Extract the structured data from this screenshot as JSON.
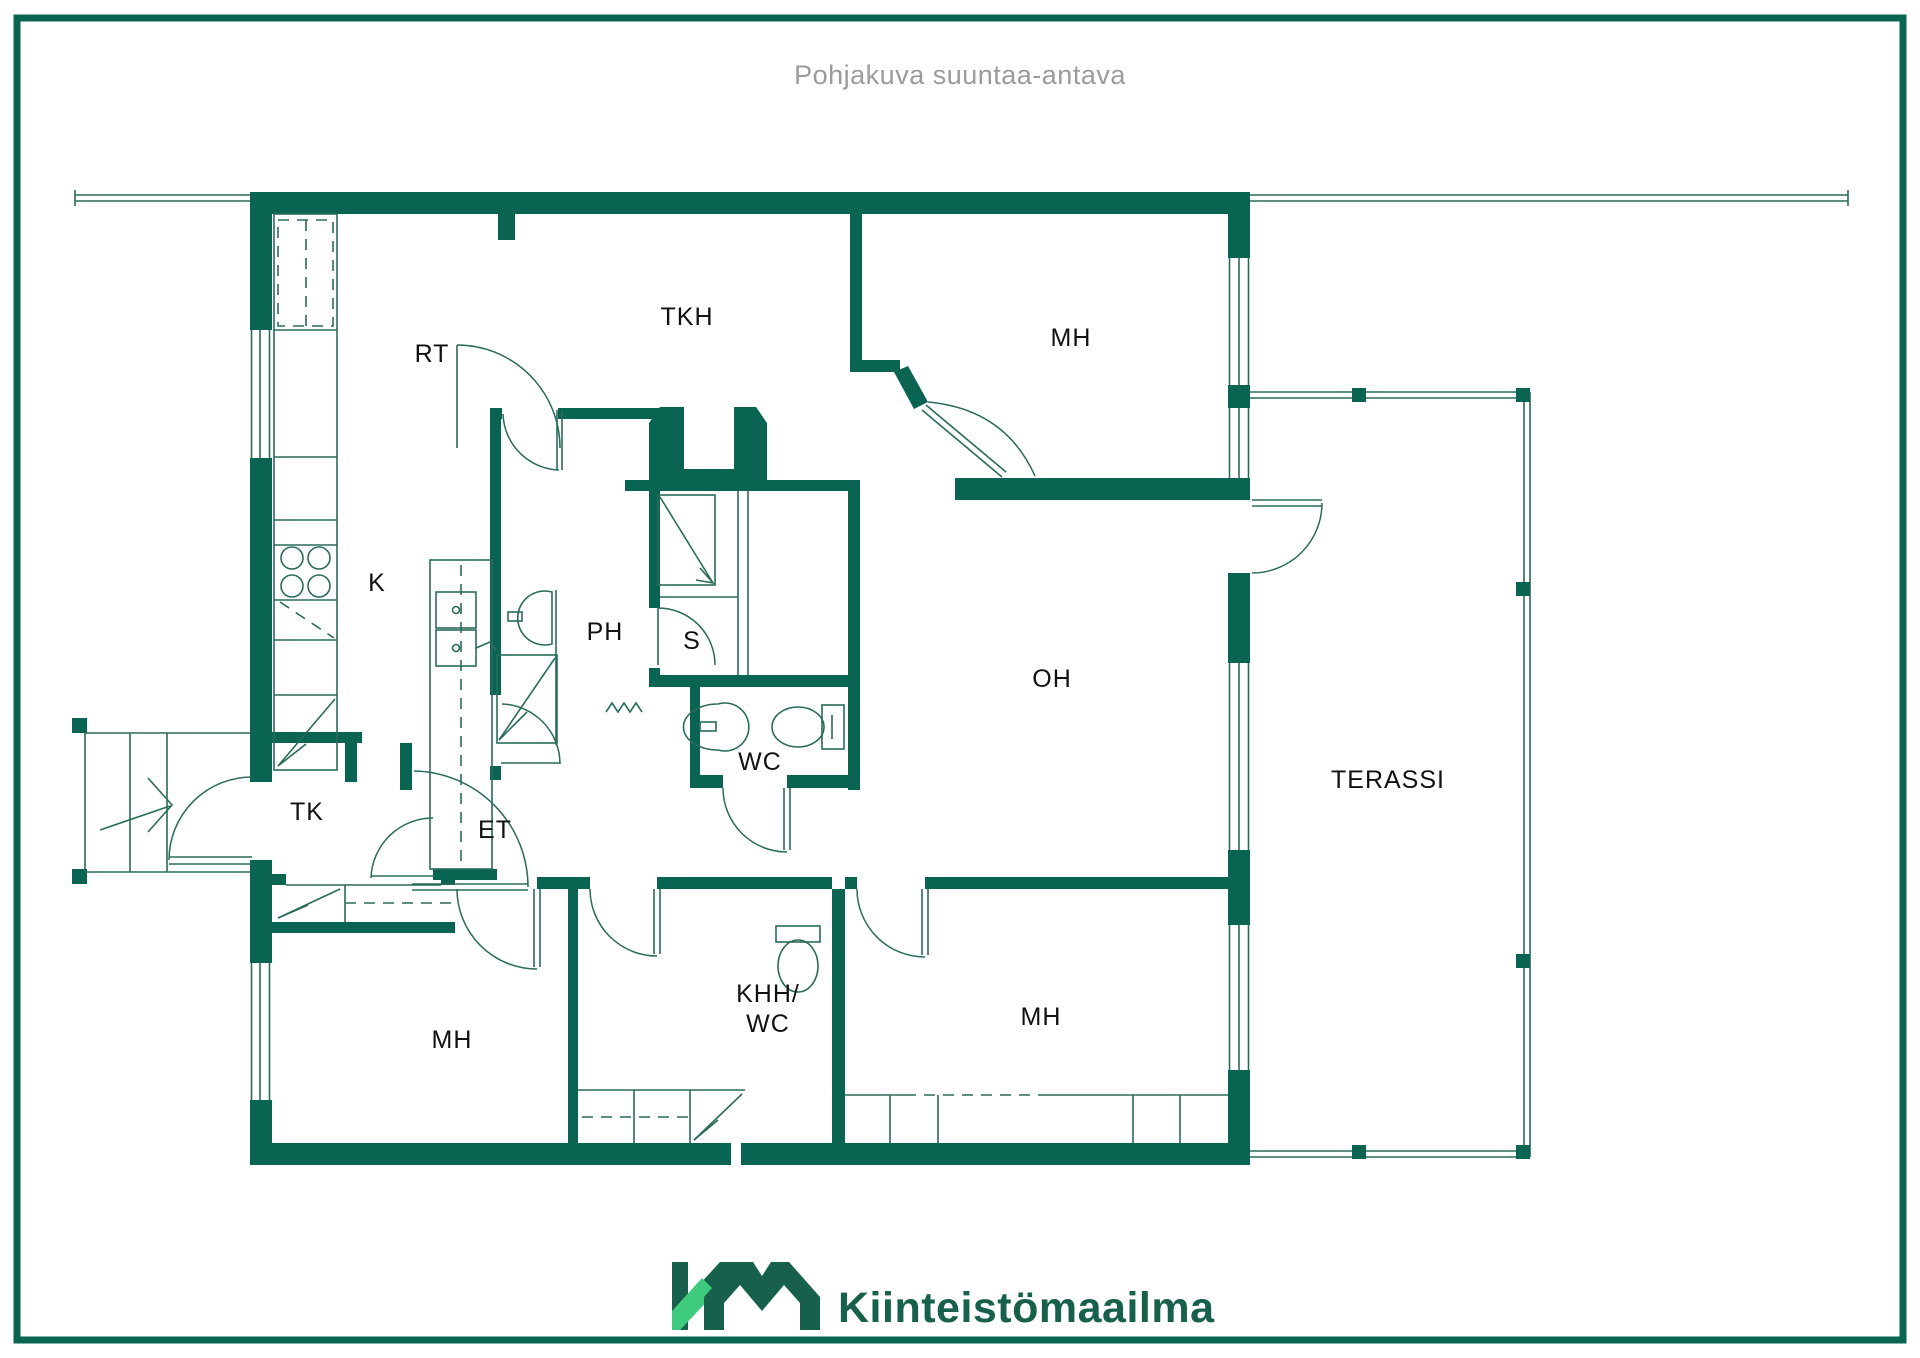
{
  "header": {
    "disclaimer": "Pohjakuva suuntaa-antava"
  },
  "footer": {
    "logo_text": "Kiinteistömaailma",
    "logo_mark": "KM-monogram"
  },
  "colors": {
    "wall_green": "#0a6452",
    "thin_line_green": "#2a6b59",
    "logo_light_green": "#3fcb7d",
    "logo_dark_green": "#17604b",
    "title_gray": "#9b9b9b"
  },
  "floorplan": {
    "rooms": [
      {
        "id": "rt",
        "lines": [
          "RT"
        ],
        "x": 432,
        "y": 354
      },
      {
        "id": "tkh",
        "lines": [
          "TKH"
        ],
        "x": 687,
        "y": 317
      },
      {
        "id": "mh-top",
        "lines": [
          "MH"
        ],
        "x": 1071,
        "y": 338
      },
      {
        "id": "k",
        "lines": [
          "K"
        ],
        "x": 377,
        "y": 583
      },
      {
        "id": "ph",
        "lines": [
          "PH"
        ],
        "x": 605,
        "y": 632
      },
      {
        "id": "s",
        "lines": [
          "S"
        ],
        "x": 692,
        "y": 641
      },
      {
        "id": "oh",
        "lines": [
          "OH"
        ],
        "x": 1052,
        "y": 679
      },
      {
        "id": "wc",
        "lines": [
          "WC"
        ],
        "x": 760,
        "y": 762
      },
      {
        "id": "tk",
        "lines": [
          "TK"
        ],
        "x": 307,
        "y": 812
      },
      {
        "id": "et",
        "lines": [
          "ET"
        ],
        "x": 495,
        "y": 830
      },
      {
        "id": "terassi",
        "lines": [
          "TERASSI"
        ],
        "x": 1388,
        "y": 780
      },
      {
        "id": "khh-wc",
        "lines": [
          "KHH/",
          "WC"
        ],
        "x": 768,
        "y": 1008
      },
      {
        "id": "mh-bl",
        "lines": [
          "MH"
        ],
        "x": 452,
        "y": 1040
      },
      {
        "id": "mh-br",
        "lines": [
          "MH"
        ],
        "x": 1041,
        "y": 1017
      }
    ]
  }
}
